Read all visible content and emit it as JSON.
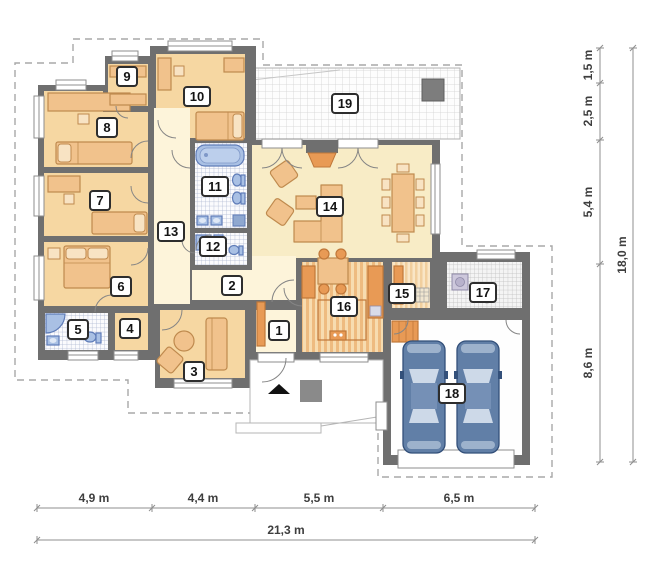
{
  "rooms": [
    {
      "n": "1"
    },
    {
      "n": "2"
    },
    {
      "n": "3"
    },
    {
      "n": "4"
    },
    {
      "n": "5"
    },
    {
      "n": "6"
    },
    {
      "n": "7"
    },
    {
      "n": "8"
    },
    {
      "n": "9"
    },
    {
      "n": "10"
    },
    {
      "n": "11"
    },
    {
      "n": "12"
    },
    {
      "n": "13"
    },
    {
      "n": "14"
    },
    {
      "n": "15"
    },
    {
      "n": "16"
    },
    {
      "n": "17"
    },
    {
      "n": "18"
    },
    {
      "n": "19"
    }
  ],
  "dimensions": {
    "bottom": {
      "segments": [
        "4,9 m",
        "4,4 m",
        "5,5 m",
        "6,5 m"
      ],
      "total": "21,3 m"
    },
    "right": {
      "segments": [
        "1,5 m",
        "2,5 m",
        "5,4 m",
        "8,6 m"
      ],
      "total": "18,0 m"
    }
  },
  "colors": {
    "wall": "#6f6f6f",
    "room_peach": "#f6d7a2",
    "hall_cream": "#fdf4da",
    "living_cream": "#f8ecc6",
    "furniture": "#f1c28c",
    "counter_orange": "#e89a55",
    "fixture_blue": "#a9c0e4",
    "tile_line_blue": "#a9b3cf",
    "car_body": "#617fa7",
    "terrace_grid": "#d2d2d2",
    "dashed_outline": "#a8a8a8",
    "dimension_text": "#3e3e3e"
  }
}
